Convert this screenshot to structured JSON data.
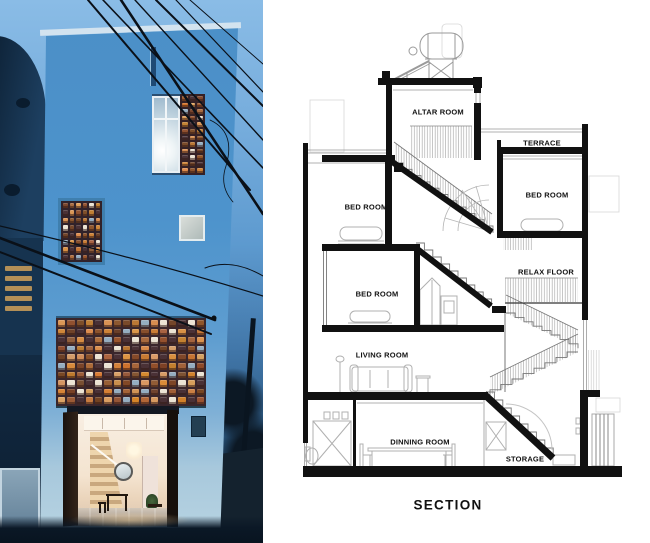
{
  "section": {
    "rooms": [
      {
        "label": "ALTAR ROOM"
      },
      {
        "label": "TERRACE"
      },
      {
        "label": "BED ROOM"
      },
      {
        "label": "BED ROOM"
      },
      {
        "label": "RELAX FLOOR"
      },
      {
        "label": "BED ROOM"
      },
      {
        "label": "LIVING ROOM"
      },
      {
        "label": "DINNING ROOM"
      },
      {
        "label": "STORAGE"
      }
    ],
    "title": "SECTION"
  },
  "photo": {
    "palette": {
      "sky": "#7fb3e0",
      "facade": "#4a90c9",
      "brick_glow": "#d08a4a",
      "night": "#0d2033"
    }
  }
}
